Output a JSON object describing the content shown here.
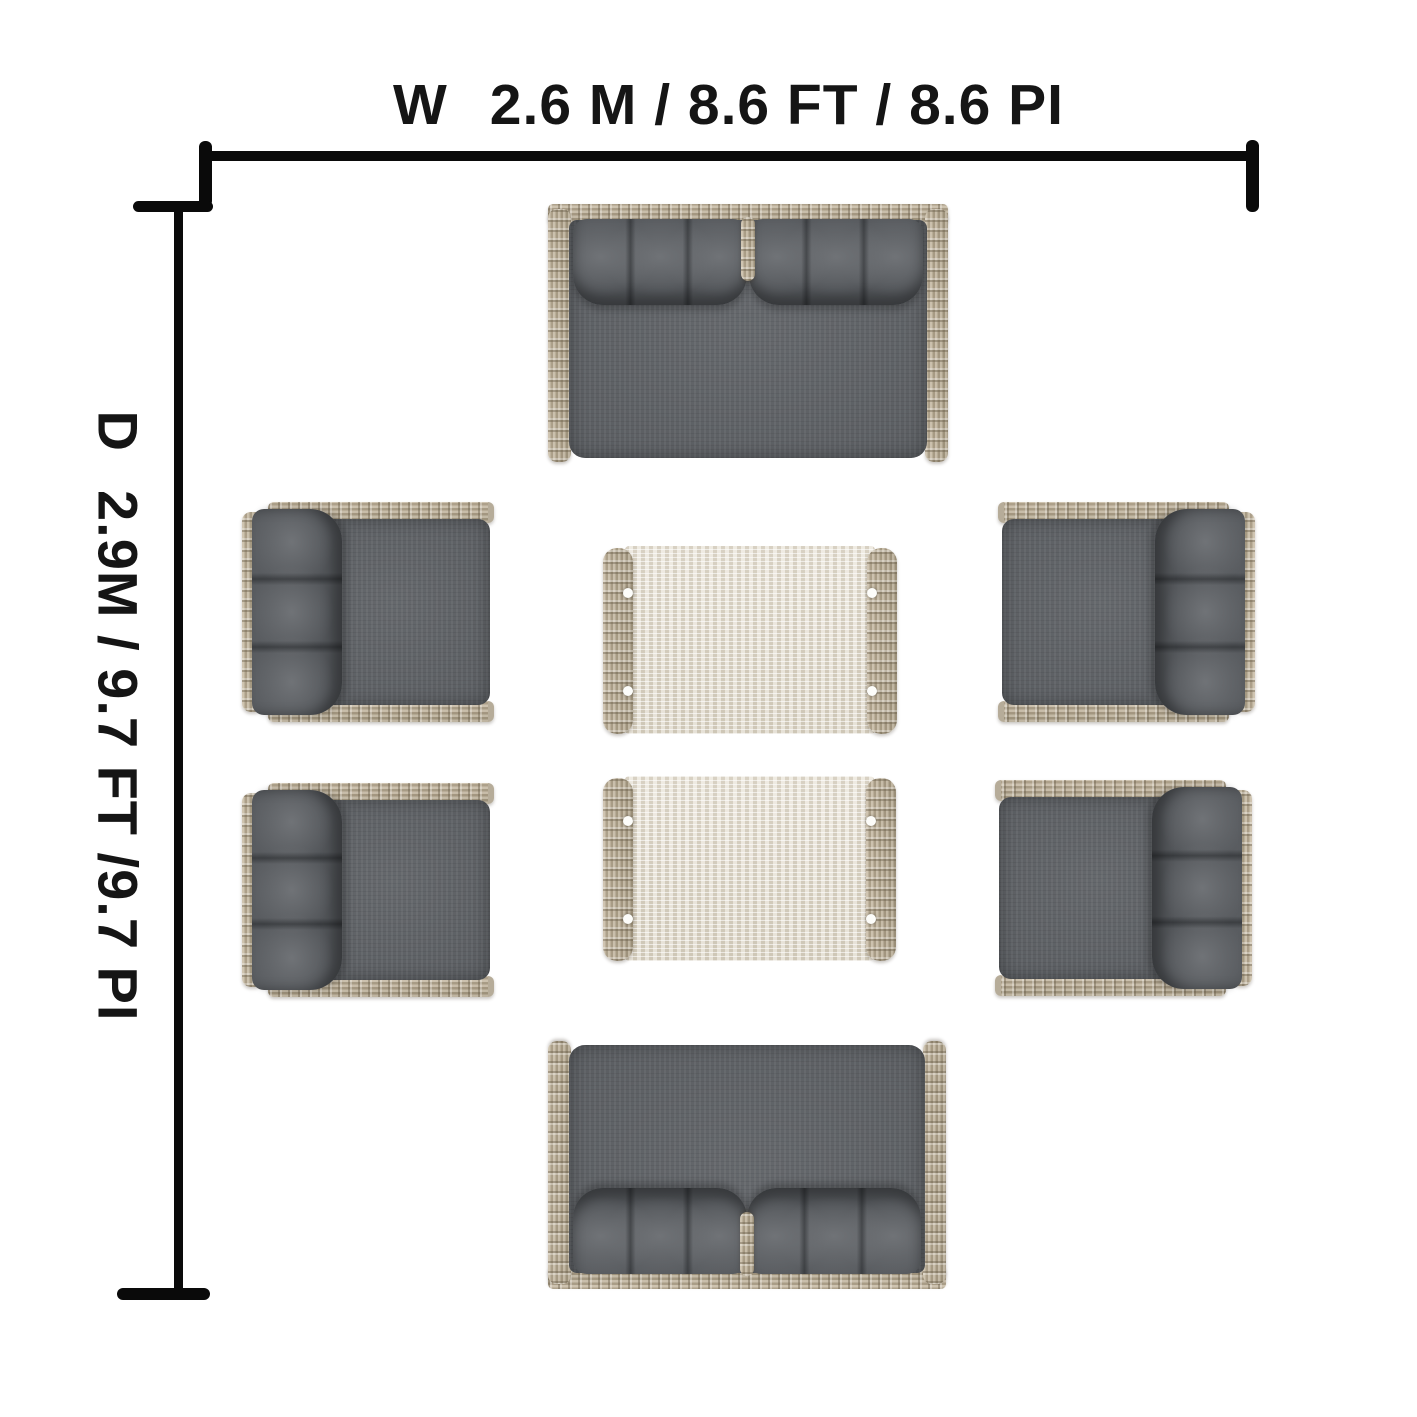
{
  "page": {
    "title": "Outdoor wicker seating set — top view dimension diagram",
    "background": "#ffffff"
  },
  "labels": {
    "width": {
      "prefix": "W",
      "value": "2.6 M / 8.6 FT / 8.6 PI"
    },
    "depth": {
      "prefix": "D",
      "value": "2.9M / 9.7 FT /9.7 PI"
    }
  },
  "colors": {
    "dimension_line": "#0a0a0a",
    "label_text": "#151515",
    "wicker_frame": "#bcae95",
    "wicker_shadow": "#8f8470",
    "seat_cushion": "#5d6064",
    "back_pillow": "#55585c",
    "table_top": "#e3ddd0",
    "table_rail": "#b3a58a",
    "table_foot_dot": "#fdfdfa"
  },
  "furniture": {
    "loveseat_top": {
      "type": "loveseat",
      "position": "top-center"
    },
    "loveseat_bottom": {
      "type": "loveseat",
      "position": "bottom-center"
    },
    "armchair_top_left": {
      "type": "armchair",
      "position": "middle-left-upper"
    },
    "armchair_bottom_left": {
      "type": "armchair",
      "position": "middle-left-lower"
    },
    "armchair_top_right": {
      "type": "armchair",
      "position": "middle-right-upper"
    },
    "armchair_bottom_right": {
      "type": "armchair",
      "position": "middle-right-lower"
    },
    "coffee_table_top": {
      "type": "coffee-table",
      "position": "center-upper"
    },
    "coffee_table_bottom": {
      "type": "coffee-table",
      "position": "center-lower"
    }
  }
}
